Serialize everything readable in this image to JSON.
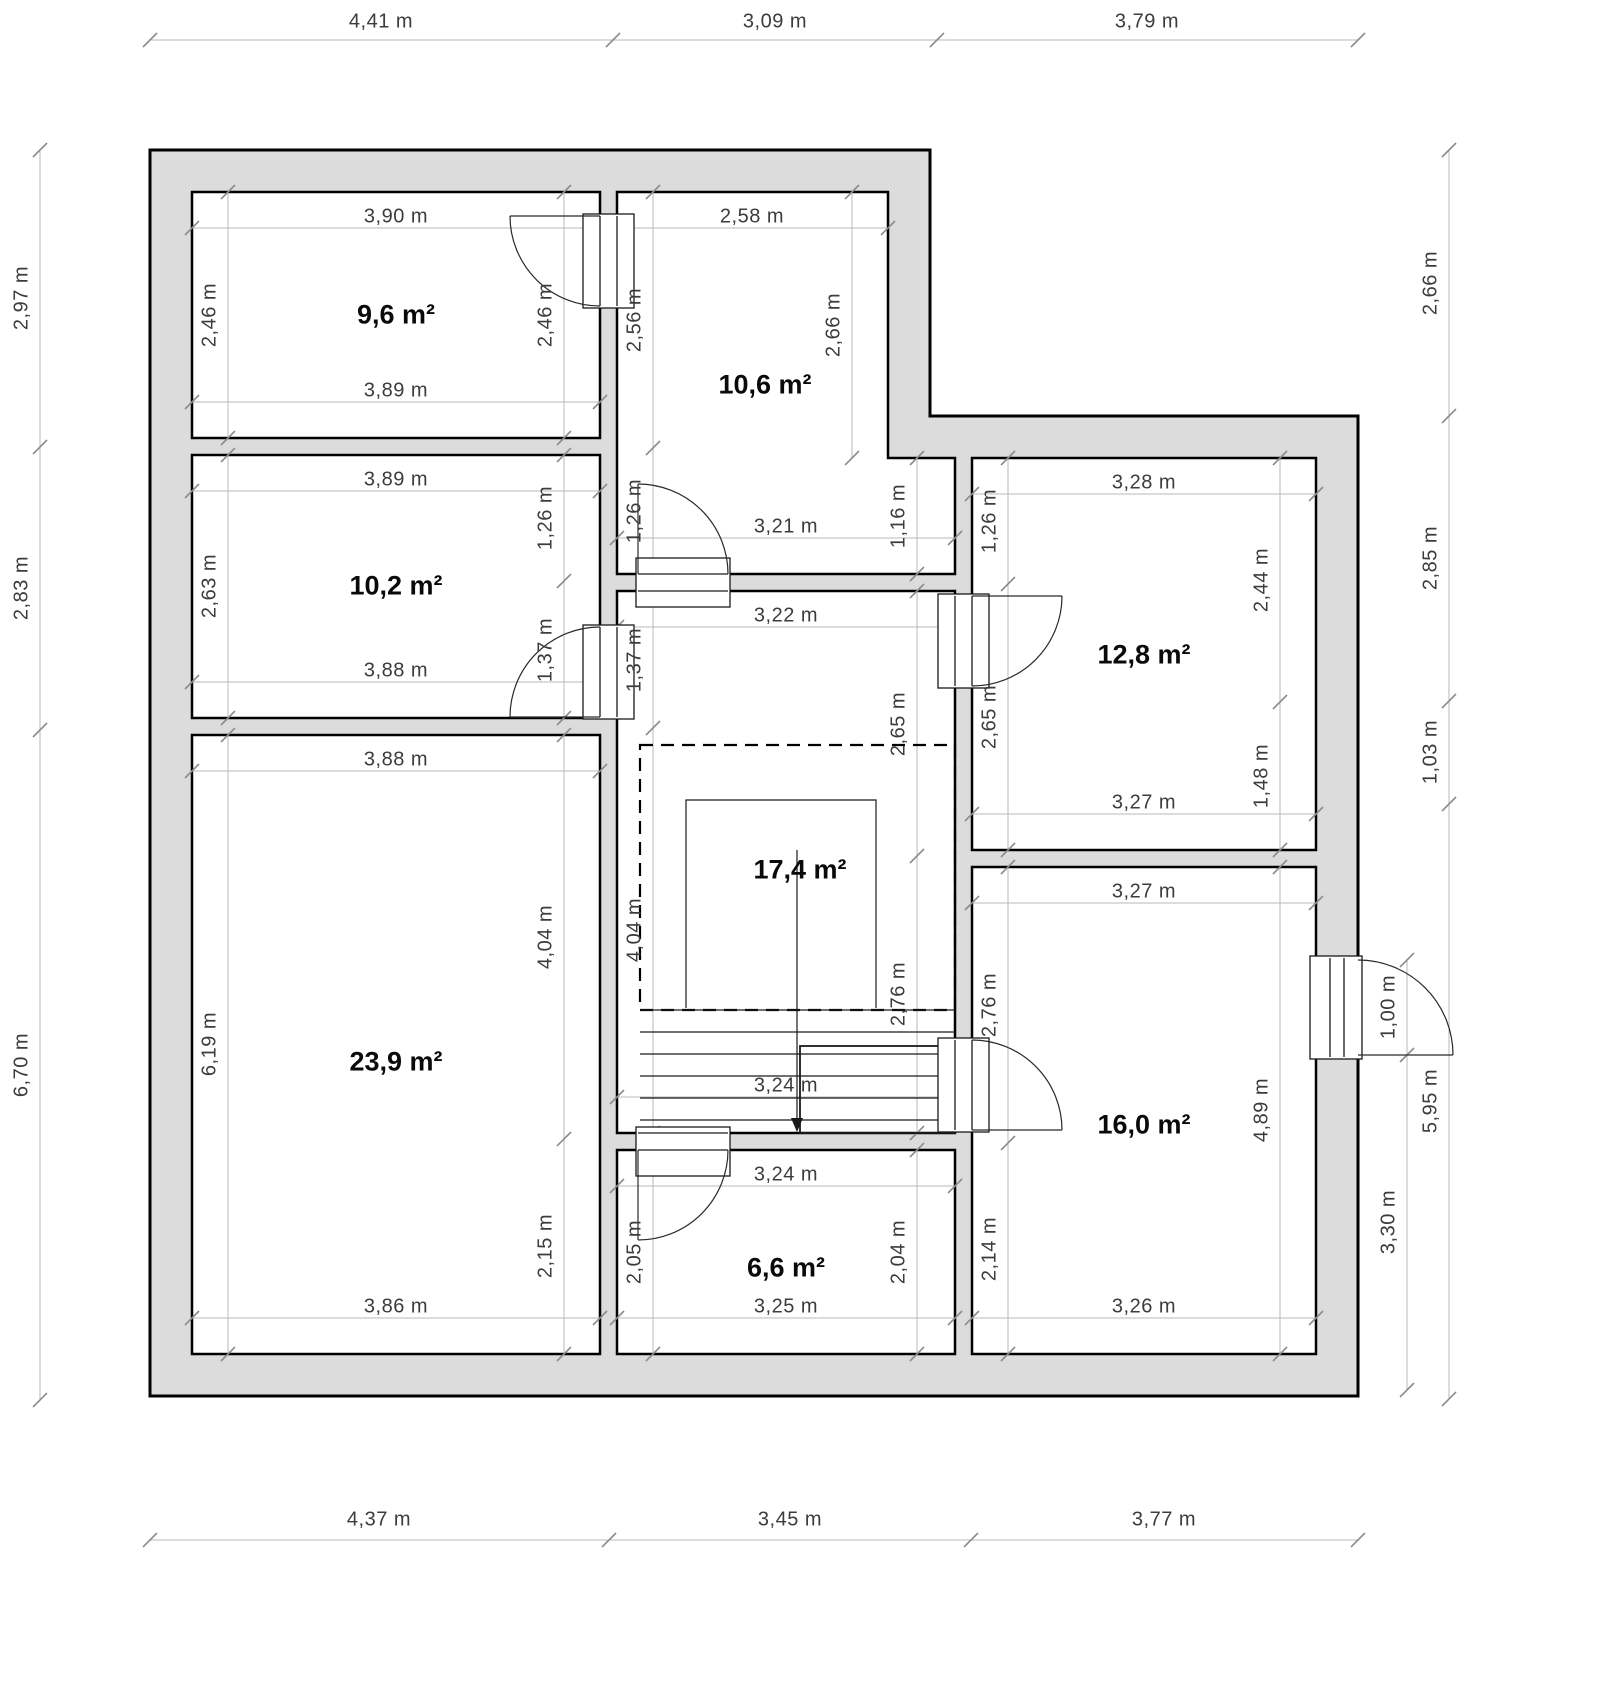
{
  "plan": {
    "title": "floor-plan",
    "unit": "m",
    "colors": {
      "wall_fill": "#dcdcdc",
      "wall_line": "#000000",
      "dim_line": "#b8b8b8",
      "dim_tick": "#8c8c8c",
      "dim_text": "#3c3c3c",
      "room_text": "#0a0a0a",
      "background": "#ffffff"
    },
    "room_labels": [
      {
        "text": "9,6 m²",
        "x": 396,
        "y": 315
      },
      {
        "text": "10,6 m²",
        "x": 765,
        "y": 385
      },
      {
        "text": "10,2 m²",
        "x": 396,
        "y": 586
      },
      {
        "text": "12,8 m²",
        "x": 1144,
        "y": 655
      },
      {
        "text": "17,4 m²",
        "x": 800,
        "y": 870
      },
      {
        "text": "23,9 m²",
        "x": 396,
        "y": 1062
      },
      {
        "text": "16,0 m²",
        "x": 1144,
        "y": 1125
      },
      {
        "text": "6,6 m²",
        "x": 786,
        "y": 1268
      }
    ],
    "dim_labels": [
      {
        "text": "4,41 m",
        "x": 381,
        "y": 22,
        "rot": 0
      },
      {
        "text": "3,09 m",
        "x": 775,
        "y": 22,
        "rot": 0
      },
      {
        "text": "3,79 m",
        "x": 1147,
        "y": 22,
        "rot": 0
      },
      {
        "text": "4,37 m",
        "x": 379,
        "y": 1520,
        "rot": 0
      },
      {
        "text": "3,45 m",
        "x": 790,
        "y": 1520,
        "rot": 0
      },
      {
        "text": "3,77 m",
        "x": 1164,
        "y": 1520,
        "rot": 0
      },
      {
        "text": "2,97 m",
        "x": 22,
        "y": 298,
        "rot": -90
      },
      {
        "text": "2,83 m",
        "x": 22,
        "y": 588,
        "rot": -90
      },
      {
        "text": "6,70 m",
        "x": 22,
        "y": 1065,
        "rot": -90
      },
      {
        "text": "2,66 m",
        "x": 1431,
        "y": 283,
        "rot": -90
      },
      {
        "text": "2,85 m",
        "x": 1431,
        "y": 558,
        "rot": -90
      },
      {
        "text": "1,03 m",
        "x": 1431,
        "y": 752,
        "rot": -90
      },
      {
        "text": "5,95 m",
        "x": 1431,
        "y": 1101,
        "rot": -90
      },
      {
        "text": "1,00 m",
        "x": 1389,
        "y": 1007,
        "rot": -90
      },
      {
        "text": "3,30 m",
        "x": 1389,
        "y": 1222,
        "rot": -90
      },
      {
        "text": "3,90 m",
        "x": 396,
        "y": 217,
        "rot": 0
      },
      {
        "text": "2,46 m",
        "x": 210,
        "y": 315,
        "rot": -90
      },
      {
        "text": "2,46 m",
        "x": 546,
        "y": 315,
        "rot": -90
      },
      {
        "text": "3,89 m",
        "x": 396,
        "y": 391,
        "rot": 0
      },
      {
        "text": "3,89 m",
        "x": 396,
        "y": 480,
        "rot": 0
      },
      {
        "text": "2,63 m",
        "x": 210,
        "y": 586,
        "rot": -90
      },
      {
        "text": "1,26 m",
        "x": 546,
        "y": 518,
        "rot": -90
      },
      {
        "text": "1,37 m",
        "x": 546,
        "y": 650,
        "rot": -90
      },
      {
        "text": "3,88 m",
        "x": 396,
        "y": 671,
        "rot": 0
      },
      {
        "text": "3,88 m",
        "x": 396,
        "y": 760,
        "rot": 0
      },
      {
        "text": "6,19 m",
        "x": 210,
        "y": 1044,
        "rot": -90
      },
      {
        "text": "4,04 m",
        "x": 546,
        "y": 937,
        "rot": -90
      },
      {
        "text": "2,15 m",
        "x": 546,
        "y": 1246,
        "rot": -90
      },
      {
        "text": "3,86 m",
        "x": 396,
        "y": 1307,
        "rot": 0
      },
      {
        "text": "2,58 m",
        "x": 752,
        "y": 217,
        "rot": 0
      },
      {
        "text": "2,56 m",
        "x": 635,
        "y": 320,
        "rot": -90
      },
      {
        "text": "1,26 m",
        "x": 635,
        "y": 511,
        "rot": -90
      },
      {
        "text": "2,66 m",
        "x": 834,
        "y": 325,
        "rot": -90
      },
      {
        "text": "1,16 m",
        "x": 899,
        "y": 516,
        "rot": -90
      },
      {
        "text": "3,21 m",
        "x": 786,
        "y": 527,
        "rot": 0
      },
      {
        "text": "3,22 m",
        "x": 786,
        "y": 616,
        "rot": 0
      },
      {
        "text": "1,37 m",
        "x": 635,
        "y": 660,
        "rot": -90
      },
      {
        "text": "4,04 m",
        "x": 635,
        "y": 930,
        "rot": -90
      },
      {
        "text": "2,65 m",
        "x": 899,
        "y": 724,
        "rot": -90
      },
      {
        "text": "2,76 m",
        "x": 899,
        "y": 994,
        "rot": -90
      },
      {
        "text": "3,24 m",
        "x": 786,
        "y": 1086,
        "rot": 0
      },
      {
        "text": "3,28 m",
        "x": 1144,
        "y": 483,
        "rot": 0
      },
      {
        "text": "1,26 m",
        "x": 990,
        "y": 521,
        "rot": -90
      },
      {
        "text": "2,65 m",
        "x": 990,
        "y": 717,
        "rot": -90
      },
      {
        "text": "2,44 m",
        "x": 1262,
        "y": 580,
        "rot": -90
      },
      {
        "text": "1,48 m",
        "x": 1262,
        "y": 776,
        "rot": -90
      },
      {
        "text": "3,27 m",
        "x": 1144,
        "y": 803,
        "rot": 0
      },
      {
        "text": "3,27 m",
        "x": 1144,
        "y": 892,
        "rot": 0
      },
      {
        "text": "2,76 m",
        "x": 990,
        "y": 1005,
        "rot": -90
      },
      {
        "text": "2,14 m",
        "x": 990,
        "y": 1249,
        "rot": -90
      },
      {
        "text": "4,89 m",
        "x": 1262,
        "y": 1110,
        "rot": -90
      },
      {
        "text": "3,26 m",
        "x": 1144,
        "y": 1307,
        "rot": 0
      },
      {
        "text": "3,24 m",
        "x": 786,
        "y": 1175,
        "rot": 0
      },
      {
        "text": "2,05 m",
        "x": 635,
        "y": 1252,
        "rot": -90
      },
      {
        "text": "2,04 m",
        "x": 899,
        "y": 1252,
        "rot": -90
      },
      {
        "text": "3,25 m",
        "x": 786,
        "y": 1307,
        "rot": 0
      }
    ]
  }
}
